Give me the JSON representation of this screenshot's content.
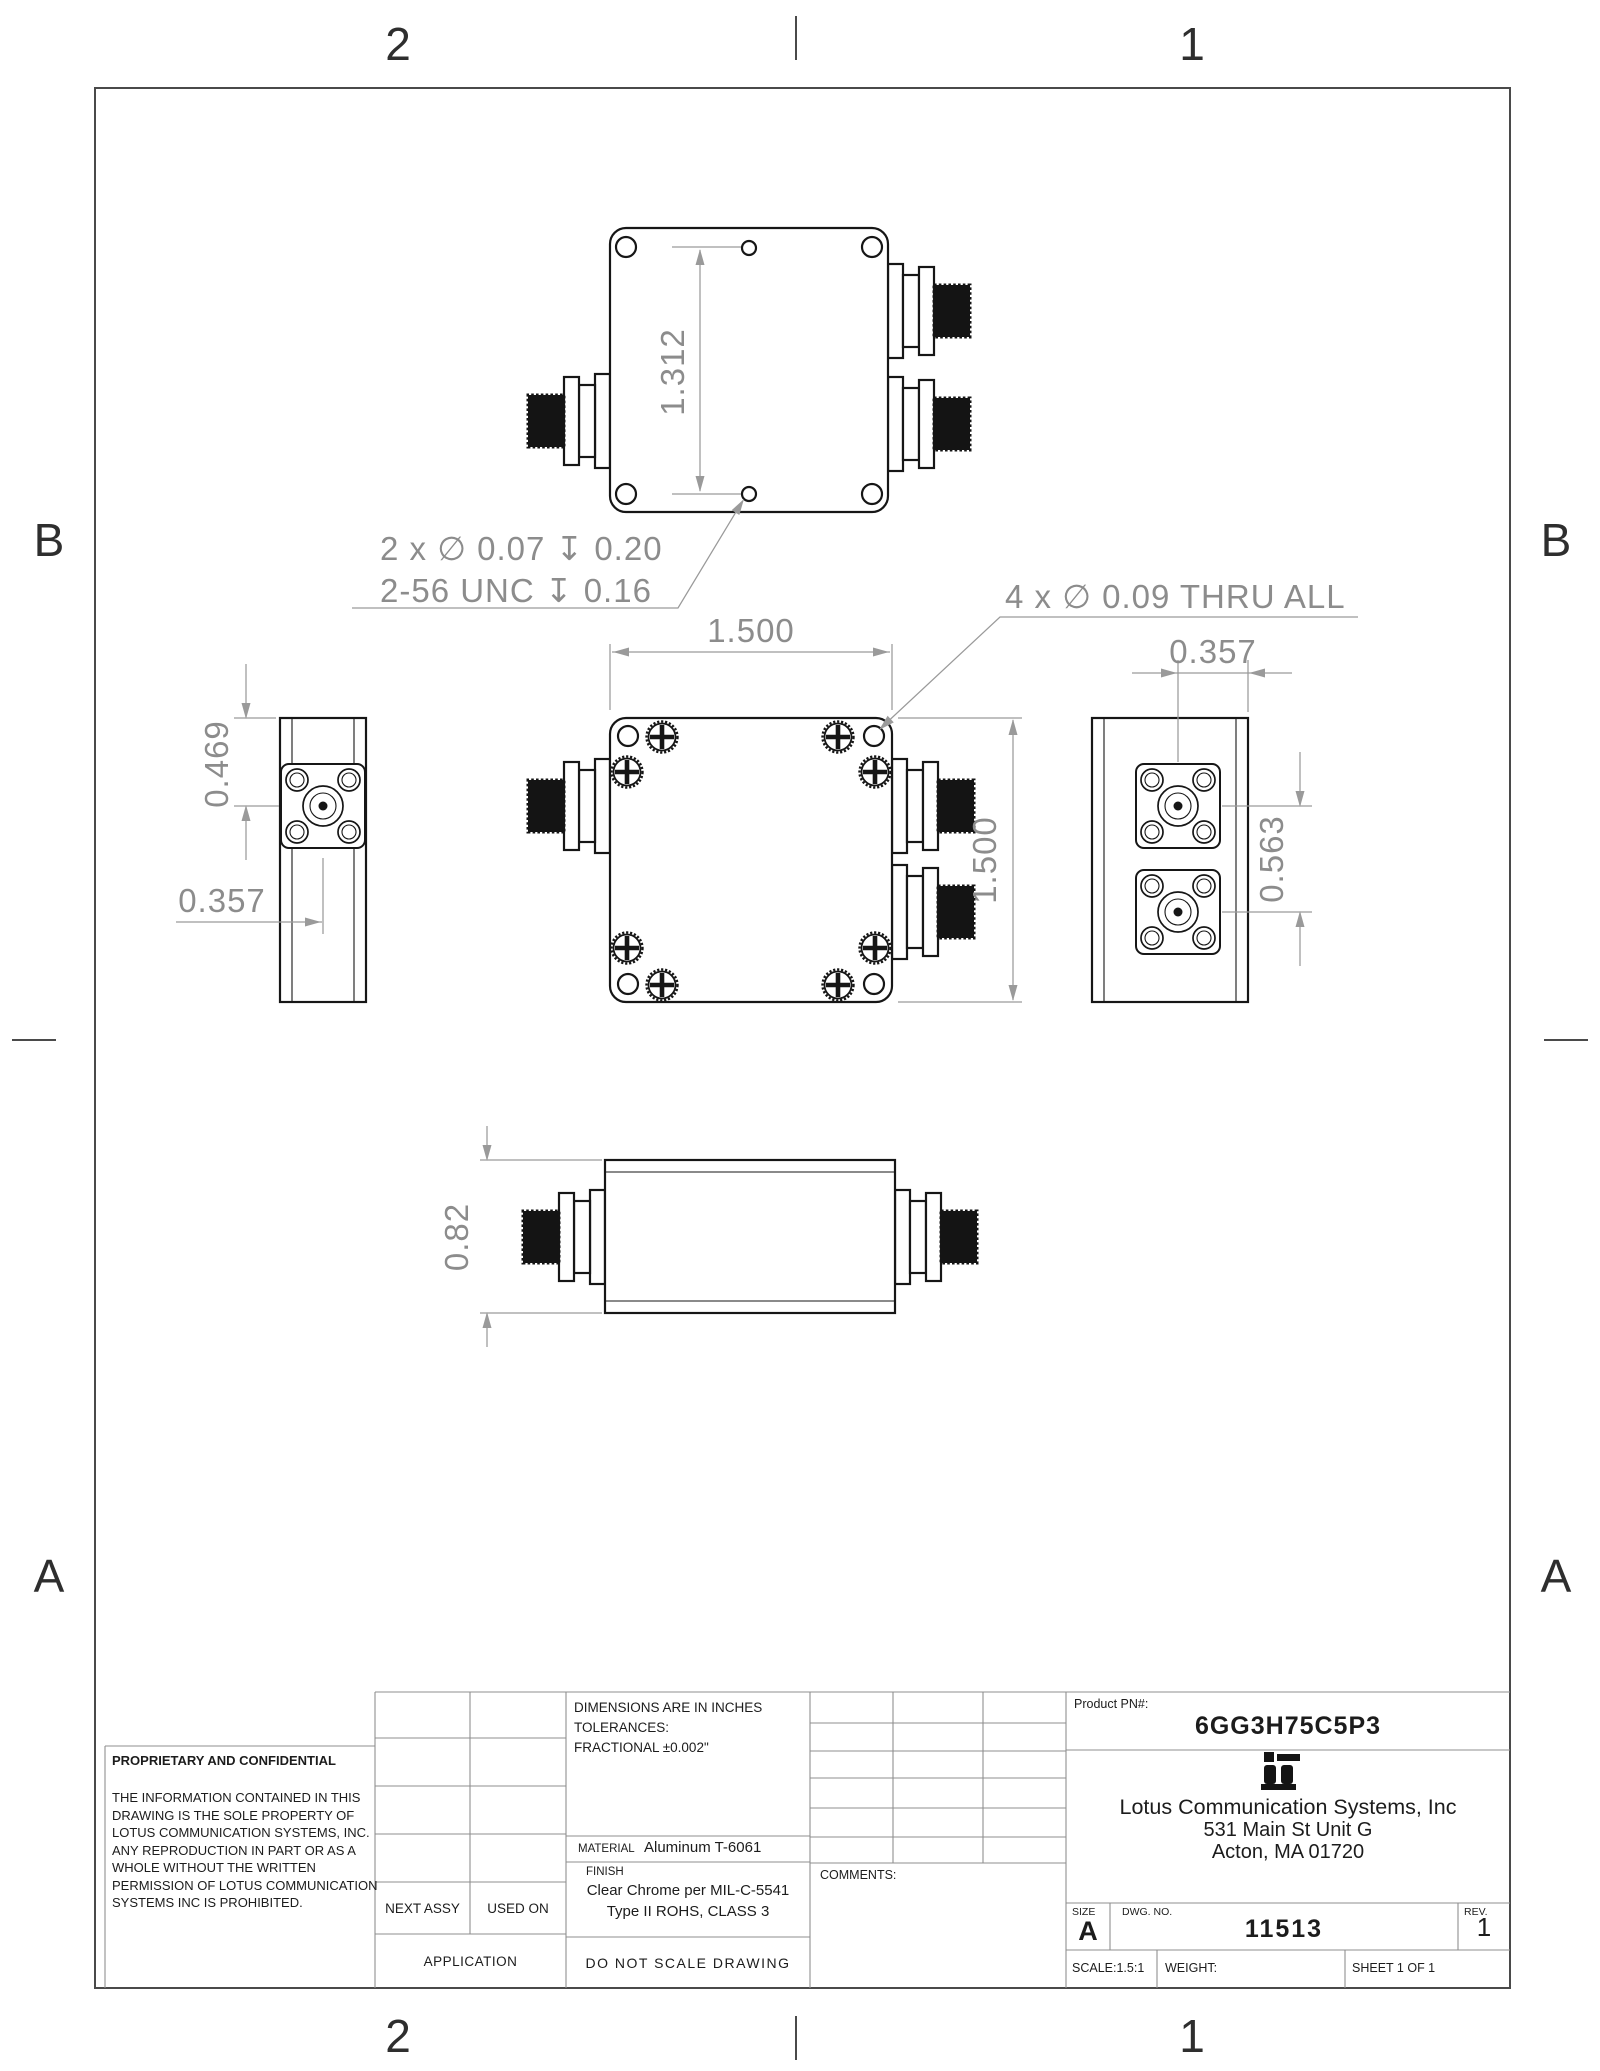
{
  "zones": {
    "col_right": "1",
    "col_left": "2",
    "row_upper": "B",
    "row_lower": "A"
  },
  "views": {
    "top_view": {
      "dim_hole_spacing": "1.312",
      "note_tapped_line1": "2 x ∅ 0.07 ↧ 0.20",
      "note_tapped_line2": "2-56 UNC ↧ 0.16"
    },
    "front_view": {
      "dim_width": "1.500",
      "dim_height": "1.500",
      "note_thru": "4 x ∅ 0.09 THRU ALL"
    },
    "left_view": {
      "dim_top_to_center": "0.469",
      "dim_center_offset": "0.357"
    },
    "right_view": {
      "dim_center_to_edge": "0.357",
      "dim_port_spacing": "0.563"
    },
    "bottom_view": {
      "dim_height": "0.82"
    }
  },
  "title_block": {
    "proprietary": {
      "heading": "PROPRIETARY AND CONFIDENTIAL",
      "body": "THE INFORMATION CONTAINED IN THIS DRAWING IS THE SOLE PROPERTY OF LOTUS COMMUNICATION SYSTEMS, INC. ANY REPRODUCTION IN PART OR AS A WHOLE WITHOUT THE WRITTEN PERMISSION OF LOTUS COMMUNICATION SYSTEMS INC IS PROHIBITED."
    },
    "application": {
      "next_assy": "NEXT ASSY",
      "used_on": "USED ON",
      "application": "APPLICATION"
    },
    "specs": {
      "dims_note_line1": "DIMENSIONS ARE IN INCHES",
      "dims_note_line2": "TOLERANCES:",
      "dims_note_line3": "FRACTIONAL ±0.002\"",
      "material_label": "MATERIAL",
      "material_value": "Aluminum T-6061",
      "finish_label": "FINISH",
      "finish_value_line1": "Clear Chrome per MIL-C-5541",
      "finish_value_line2": "Type II ROHS, CLASS 3",
      "do_not_scale": "DO NOT SCALE DRAWING",
      "comments_label": "COMMENTS:"
    },
    "product": {
      "pn_label": "Product PN#:",
      "pn_value": "6GG3H75C5P3"
    },
    "company": {
      "name": "Lotus Communication Systems, Inc",
      "address1": "531 Main St Unit G",
      "address2": "Acton, MA 01720"
    },
    "meta": {
      "size_label": "SIZE",
      "size_value": "A",
      "dwg_label": "DWG. NO.",
      "dwg_value": "11513",
      "rev_label": "REV.",
      "rev_value": "1",
      "scale": "SCALE:1.5:1",
      "weight_label": "WEIGHT:",
      "sheet": "SHEET 1 OF 1"
    }
  }
}
